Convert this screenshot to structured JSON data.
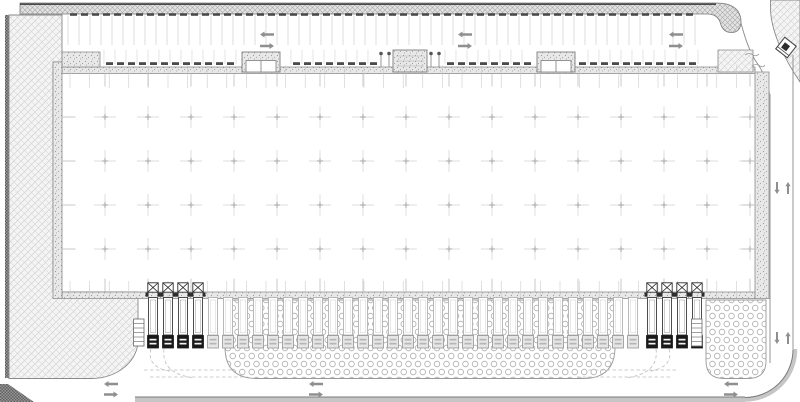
{
  "plan": {
    "title": "warehouse-site-plan",
    "canvas": {
      "w": 800,
      "h": 402
    },
    "colors": {
      "line": "#8a8a8a",
      "line_dark": "#7a7a7a",
      "edge_dark": "#4a4a4a",
      "faint": "#cfcfcf",
      "tick": "#bdbdbd",
      "joint": "#c6c6c6",
      "cross": "#d2d2d2",
      "cross_center": "#a0a0a0",
      "stop": "#4a4a4a",
      "arrow": "#8f8f8f",
      "curb": "#c6c6c6",
      "truck_dark": "#191919",
      "truck_dark_line": "#3a3a3a",
      "ghost_line": "#b2b2b2",
      "ghost_cab": "#e6e6e6",
      "dock": "#2e2e2e",
      "dash": "#bdbdbd"
    },
    "shapes": [
      {
        "name": "left-boundary-strip",
        "d": "M5,15 h4 v363 h-4 Z",
        "fill": "darkpat",
        "stroke": "none",
        "sw": 0
      },
      {
        "name": "left-boundary-corner",
        "d": "M0,384 L8,384 L34,402 L0,402 Z",
        "fill": "darkpat",
        "stroke": "none",
        "sw": 0
      },
      {
        "name": "left-landscape-area",
        "d": "M9,15 H62 V62 H53 V292 H138 V341 A47,38 0 0 1 91,378.5 H9 Z",
        "fill": "hatch",
        "stroke": "#8a8a8a",
        "sw": 0.9
      },
      {
        "name": "top-landscape-band",
        "d": "M20,3 H716 Q740,3 741,21 Q741,32.5 731.5,32.5 Q723,32.5 720.5,23.5 Q718,14 707,14 H20 Z",
        "fill": "band",
        "stroke": "#7a7a7a",
        "sw": 0.8
      },
      {
        "name": "top-band-dark-edge",
        "d": "M20,4.2 H716",
        "fill": "none",
        "stroke": "#4a4a4a",
        "sw": 1.6
      },
      {
        "name": "ne-corner-landscape",
        "d": "M770.5,0 H800 V82 Q787,63 778.5,43 Q770.5,23 770.5,8 Z",
        "fill": "hatch",
        "stroke": "#8a8a8a",
        "sw": 0.9
      },
      {
        "name": "ne-driveway-edge",
        "d": "M741,23 Q748,50 757,63 Q766.5,76 769.5,94",
        "fill": "none",
        "stroke": "#8a8a8a",
        "sw": 0.9
      },
      {
        "name": "right-road-inner-line",
        "d": "M770,94 V363",
        "fill": "none",
        "stroke": "#8a8a8a",
        "sw": 0.9
      },
      {
        "name": "right-road-outer-line",
        "d": "M793,55 V349",
        "fill": "none",
        "stroke": "#8a8a8a",
        "sw": 0.9
      },
      {
        "name": "corner-curb-band",
        "d": "M745,399.5 A50,50 0 0 0 795,349",
        "fill": "none",
        "stroke": "#c6c6c6",
        "sw": 4.5
      },
      {
        "name": "corner-curb-line",
        "d": "M745,397.5 A48,48 0 0 0 793,349.5",
        "fill": "none",
        "stroke": "#7a7a7a",
        "sw": 1
      },
      {
        "name": "bottom-curb-band",
        "d": "M135,397.5 H745 V402 H135 Z",
        "fill": "#c6c6c6",
        "stroke": "none",
        "sw": 0
      },
      {
        "name": "bottom-curb-line",
        "d": "M135,397 H745",
        "fill": "none",
        "stroke": "#7a7a7a",
        "sw": 1
      },
      {
        "name": "dock-apron-pad",
        "d": "M225,300 H615 V347 Q615,378.5 583,378.5 H257 Q225,378.5 225,347 Z",
        "fill": "dots",
        "stroke": "#999999",
        "sw": 0.9
      },
      {
        "name": "dock-apron-island",
        "d": "M706,300 H766 V361 Q766,378.5 748,378.5 H724 Q706,378.5 706,361 Z",
        "fill": "dots",
        "stroke": "#999999",
        "sw": 0.9
      },
      {
        "name": "building-wall-top",
        "d": "M62,67 H755 V73.5 H62 Z",
        "fill": "stipple",
        "stroke": "#8a8a8a",
        "sw": 0.8
      },
      {
        "name": "building-wall-bottom",
        "d": "M62,292 H755 V298.5 H62 Z",
        "fill": "stipple",
        "stroke": "#8a8a8a",
        "sw": 0.8
      },
      {
        "name": "building-wall-left",
        "d": "M53,62 H62 V298.5 H53 Z",
        "fill": "stipple",
        "stroke": "#8a8a8a",
        "sw": 0.8
      },
      {
        "name": "building-wall-right",
        "d": "M755,72 H769 V298.5 H755 Z",
        "fill": "stipple",
        "stroke": "#8a8a8a",
        "sw": 0.8
      },
      {
        "name": "nw-corner-canopy",
        "d": "M62,52 H100 V67 H62 Z",
        "fill": "stipple",
        "stroke": "#8a8a8a",
        "sw": 0.8
      },
      {
        "name": "ne-corner-planter",
        "d": "M718,50 H753 V72 H718 Z",
        "fill": "hatch",
        "stroke": "#8a8a8a",
        "sw": 0.8
      },
      {
        "name": "grading-squiggle-1",
        "d": "M745,55 q4,-3 8,0 q3,2 6,-1",
        "fill": "none",
        "stroke": "#9a9a9a",
        "sw": 0.8
      },
      {
        "name": "grading-squiggle-2",
        "d": "M752,66 q4,-3 8,0 q3,2 5,-1",
        "fill": "none",
        "stroke": "#9a9a9a",
        "sw": 0.8
      },
      {
        "name": "turning-template-left-1",
        "d": "M151,349 Q146,367 171,371.5",
        "fill": "none",
        "stroke": "#bdbdbd",
        "sw": 0.8,
        "dash": "3.5,2.5"
      },
      {
        "name": "turning-template-left-2",
        "d": "M164,349 Q161,373 192,377.5",
        "fill": "none",
        "stroke": "#bdbdbd",
        "sw": 0.8,
        "dash": "3.5,2.5"
      },
      {
        "name": "turning-template-left-3",
        "d": "M144,370 H233",
        "fill": "none",
        "stroke": "#bdbdbd",
        "sw": 0.8,
        "dash": "3.5,2.5"
      },
      {
        "name": "turning-template-left-4",
        "d": "M150,377 H243",
        "fill": "none",
        "stroke": "#bdbdbd",
        "sw": 0.8,
        "dash": "3.5,2.5"
      },
      {
        "name": "turning-template-right-1",
        "d": "M669,349 Q674,367 649,371.5",
        "fill": "none",
        "stroke": "#bdbdbd",
        "sw": 0.8,
        "dash": "3.5,2.5"
      },
      {
        "name": "turning-template-right-2",
        "d": "M656,349 Q659,373 628,377.5",
        "fill": "none",
        "stroke": "#bdbdbd",
        "sw": 0.8,
        "dash": "3.5,2.5"
      },
      {
        "name": "turning-template-right-3",
        "d": "M676,370 H587",
        "fill": "none",
        "stroke": "#bdbdbd",
        "sw": 0.8,
        "dash": "3.5,2.5"
      },
      {
        "name": "turning-template-right-4",
        "d": "M670,377 H577",
        "fill": "none",
        "stroke": "#bdbdbd",
        "sw": 0.8,
        "dash": "3.5,2.5"
      }
    ],
    "north_parking": {
      "stall_spacing": 11,
      "north_row": {
        "x0": 68,
        "count": 58,
        "y0": 15.5,
        "y1": 45
      },
      "north_stops": {
        "x0": 73.5,
        "count": 57,
        "y": 13.2,
        "w": 7,
        "h": 2.6
      },
      "south_row": {
        "x0": 104,
        "xmax": 704,
        "y0": 49.5,
        "y1": 64,
        "gaps": [
          [
            236,
            286
          ],
          [
            375,
            445
          ],
          [
            531,
            581
          ]
        ]
      },
      "south_stops": {
        "x0": 109.5,
        "xmax": 700,
        "y": 62.2,
        "w": 7,
        "h": 2.8
      },
      "aisle_arrows": {
        "x": [
          267,
          465,
          676
        ],
        "y_left": 34.5,
        "y_right": 46
      }
    },
    "building": {
      "column_grid": {
        "x0": 105,
        "dx": 43,
        "cols": 16,
        "y0": 117,
        "dy": 44,
        "rows": 4,
        "arm": 11
      },
      "panel_joints": {
        "x0": 70,
        "step": 19.6,
        "xmax": 751,
        "top": [
          65.5,
          88
        ],
        "bottom": [
          281,
          298
        ]
      },
      "col_ticks": {
        "top": [
          73.5,
          86.5
        ],
        "bottom": [
          278.5,
          291.5
        ]
      },
      "row_ticks": {
        "left": [
          62,
          75.5
        ],
        "right": [
          741.5,
          755
        ]
      }
    },
    "entrances": {
      "doors": [
        {
          "x": 242
        },
        {
          "x": 537
        }
      ],
      "door_w": 38,
      "door_y": 52,
      "door_h": 20,
      "center_block": {
        "x": 393,
        "y": 50,
        "w": 34,
        "h": 22
      },
      "bollards": [
        381,
        389,
        431,
        439
      ]
    },
    "docks": {
      "left_x": [
        153,
        168,
        183,
        198
      ],
      "right_x": [
        652,
        667,
        682,
        697
      ],
      "box_y": 282.8,
      "box_w": 10.4,
      "box_h": 9.4
    },
    "trailers": {
      "ghost_x0": 213,
      "spacing": 15,
      "ghost_count": 29,
      "trailer_y": 297.5,
      "trailer_h": 37.5,
      "cab_y": 335.5,
      "cab_h": 12.5
    },
    "stairs": [
      {
        "x": 133.5,
        "y": 319
      },
      {
        "x": 691.5,
        "y": 319
      }
    ],
    "road_arrows": {
      "bottom": {
        "x": [
          111,
          316,
          731
        ],
        "y_left": 384,
        "y_right": 394.5
      },
      "right": {
        "x_down": 777,
        "x_up": 788,
        "ys": [
          188,
          338
        ]
      }
    },
    "guard_booth": {
      "cx": 786,
      "cy": 47.5,
      "size": 14.6,
      "angle": 38
    }
  }
}
